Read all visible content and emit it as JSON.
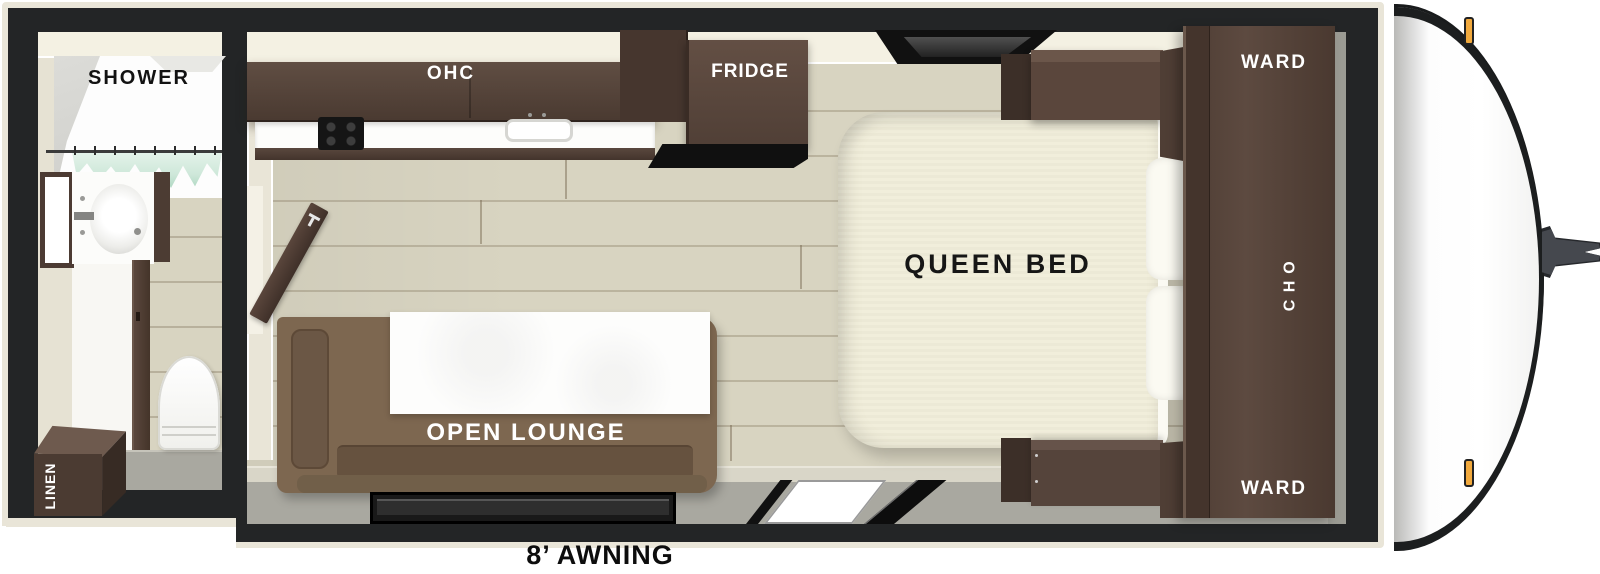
{
  "floorplan": {
    "bathroom": {
      "shower": "SHOWER",
      "linen": "LINEN"
    },
    "kitchen": {
      "ohc": "OHC",
      "fridge": "FRIDGE"
    },
    "lounge": {
      "open_lounge": "OPEN LOUNGE"
    },
    "bedroom": {
      "queen_bed": "QUEEN BED",
      "ward_top": "WARD",
      "ohc_side": "OHC",
      "ward_bottom": "WARD"
    },
    "exterior": {
      "awning": "8’ AWNING"
    }
  },
  "colors": {
    "frame_black": "#232526",
    "outer_trim": "#e9e5d8",
    "wall_cream": "#e6e2d3",
    "wall_light": "#f4f1e3",
    "wood_floor": "#d8d4c1",
    "gray_walkway": "#a9a8a0",
    "cabinet_dark_wood": "#4e3d34",
    "sofa_brown": "#7d6750",
    "mattress_cream": "#f1eedb",
    "curtain_mint": "#cfe8da",
    "marker_amber": "#f1a93d"
  }
}
